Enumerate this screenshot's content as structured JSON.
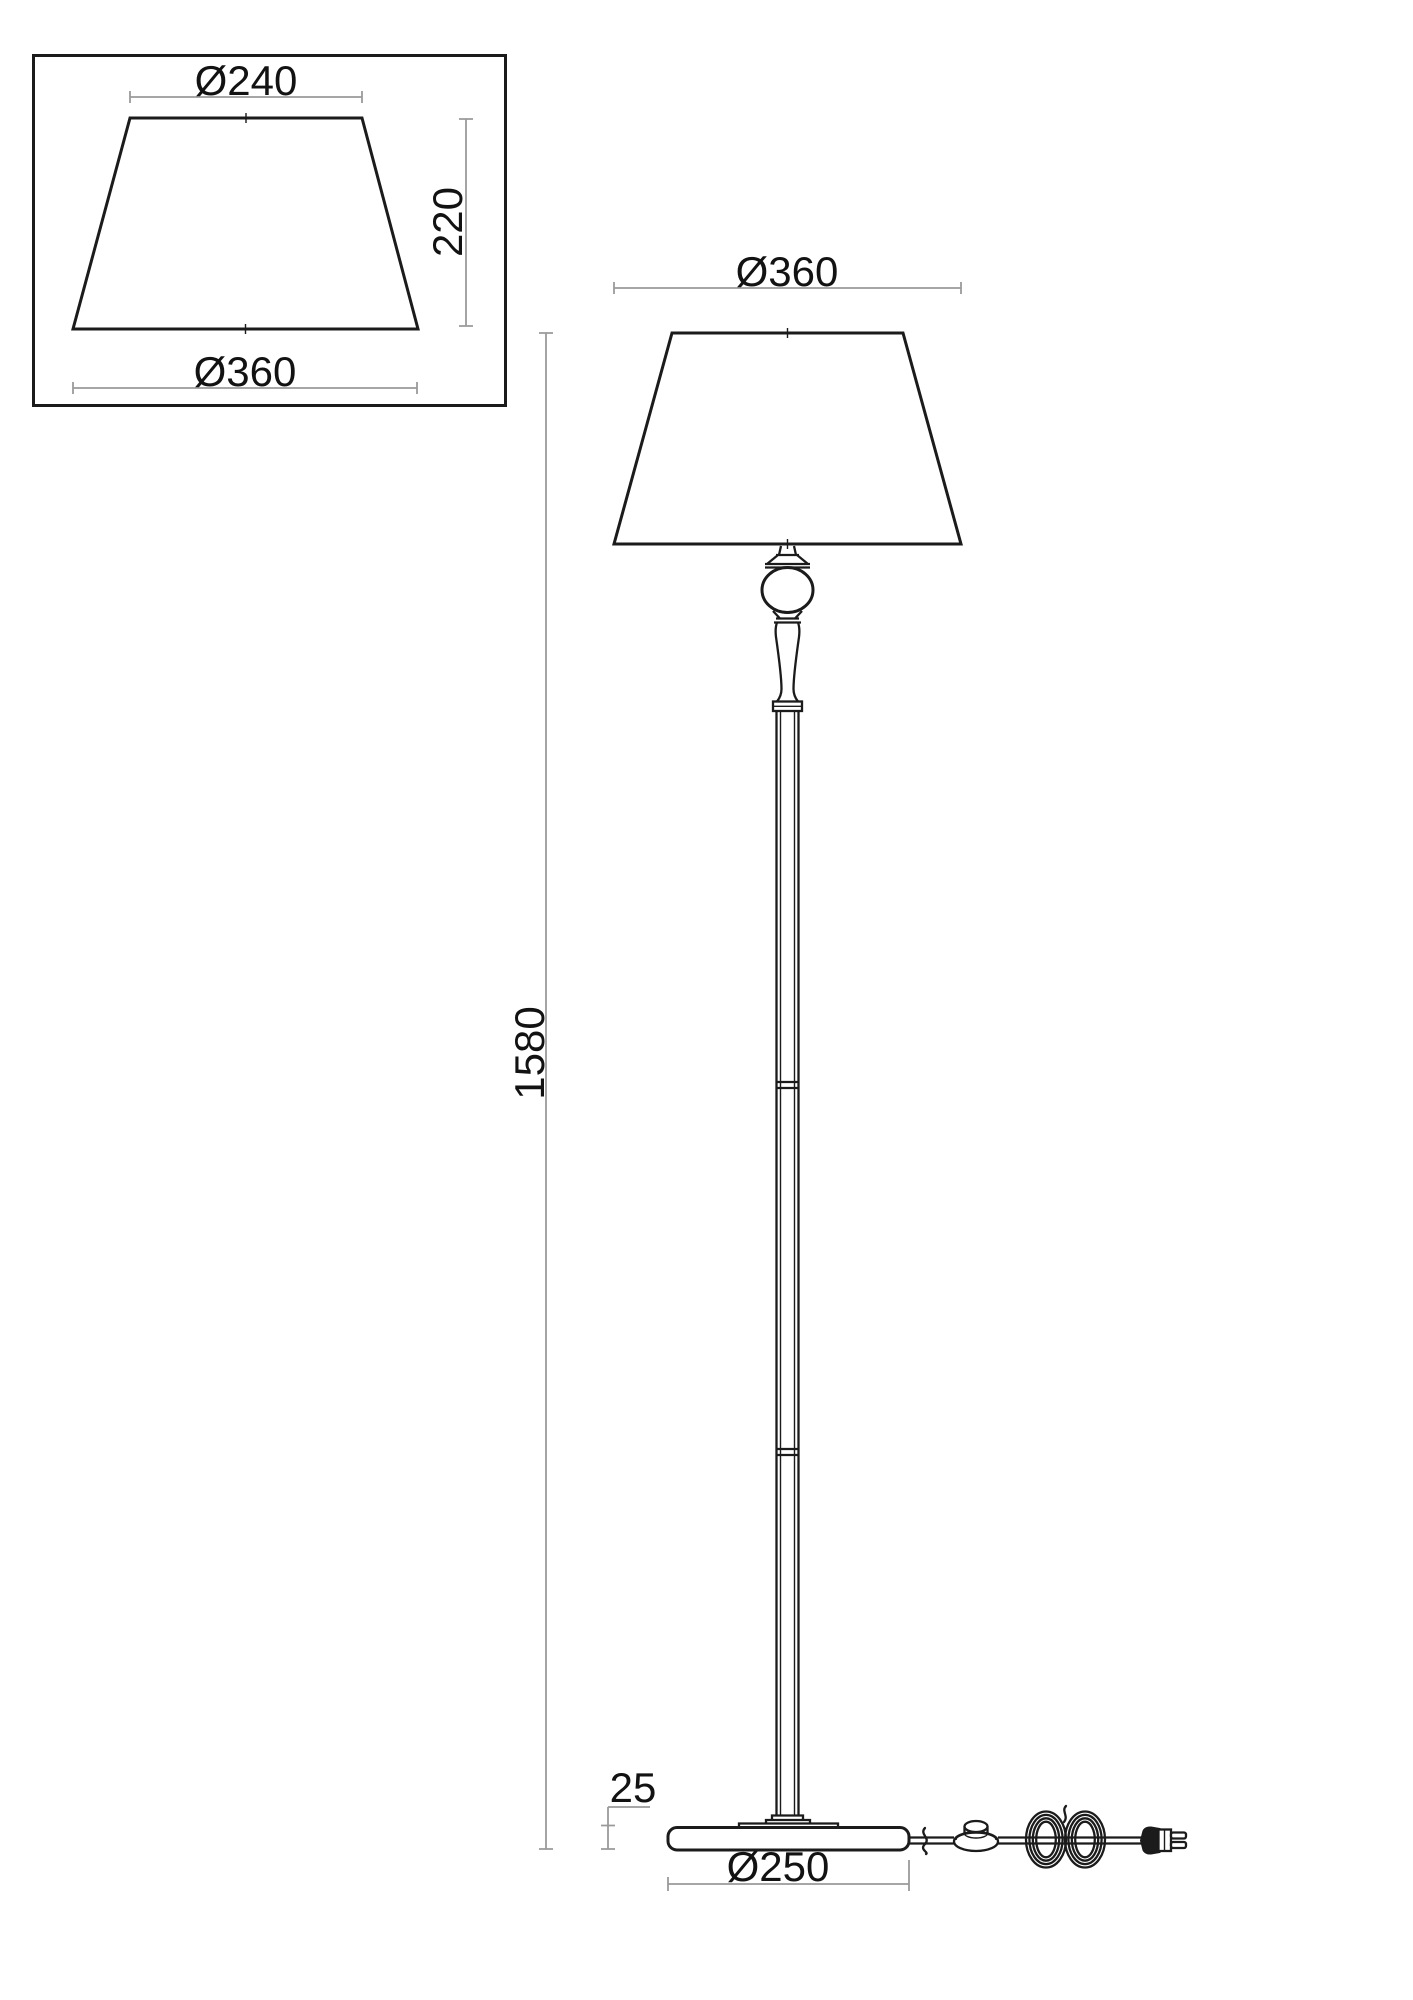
{
  "colors": {
    "line": "#1b1b1b",
    "dim_line": "#9a9a9a",
    "text": "#121212",
    "background": "#ffffff"
  },
  "detail_view": {
    "top_diameter_label": "Ø240",
    "height_label": "220",
    "bottom_diameter_label": "Ø360"
  },
  "main_view": {
    "shade_diameter_label": "Ø360",
    "total_height_label": "1580",
    "base_height_label": "25",
    "base_diameter_label": "Ø250"
  }
}
